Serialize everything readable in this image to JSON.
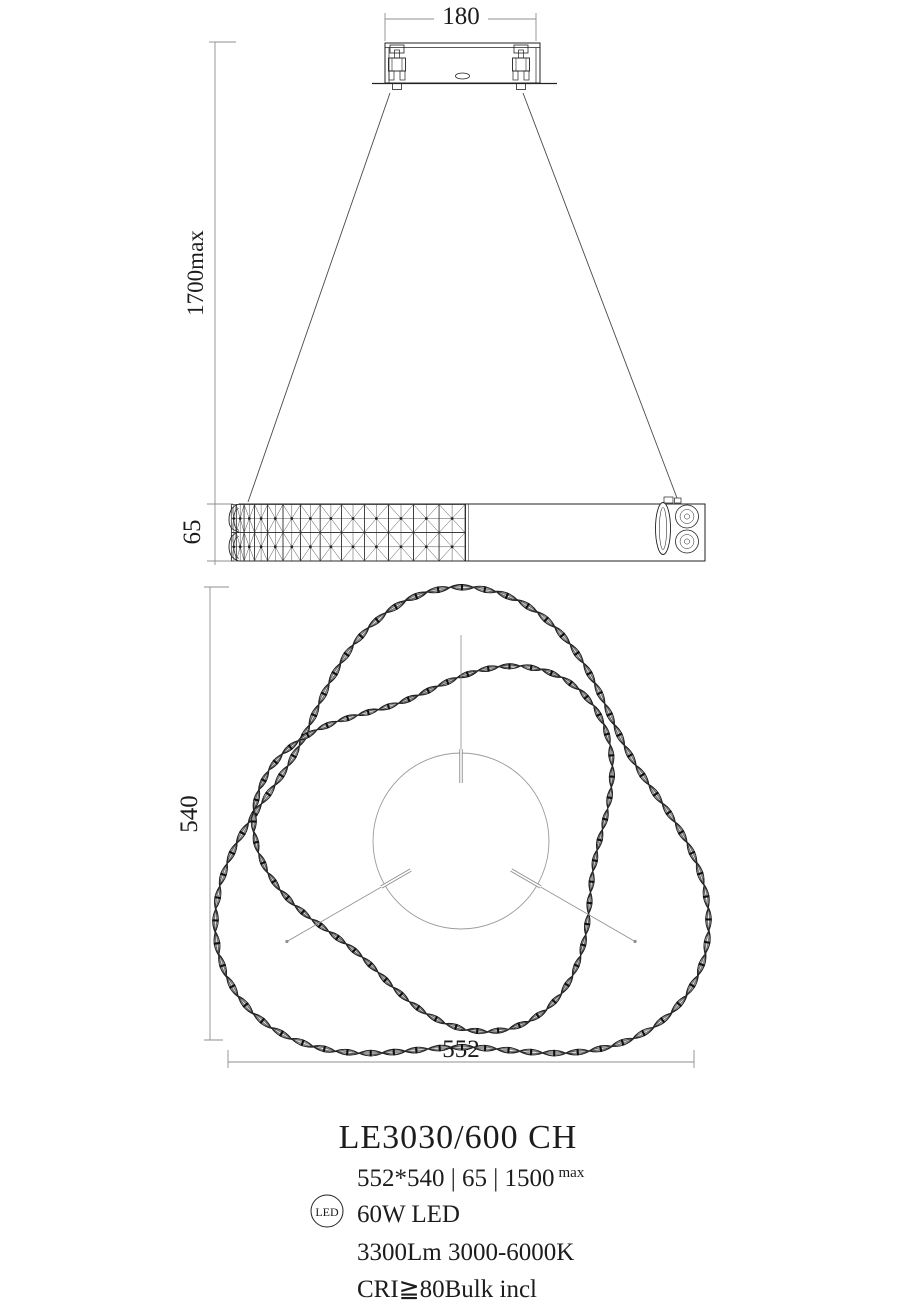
{
  "drawing": {
    "dim_canopy_width": "180",
    "dim_suspension": "1700max",
    "dim_band_height": "65",
    "dim_depth": "540",
    "dim_width": "552"
  },
  "spec": {
    "model": "LE3030/600 CH",
    "size_line": "552*540 | 65 | 1500",
    "size_sup": "max",
    "led_badge": "LED",
    "power": "60W LED",
    "output": "3300Lm 3000-6000K",
    "cri_line": "CRI≧80Bulk incl"
  },
  "colors": {
    "ink": "#1c1c1c",
    "dim_line": "#8f8f8f",
    "background": "#ffffff"
  }
}
